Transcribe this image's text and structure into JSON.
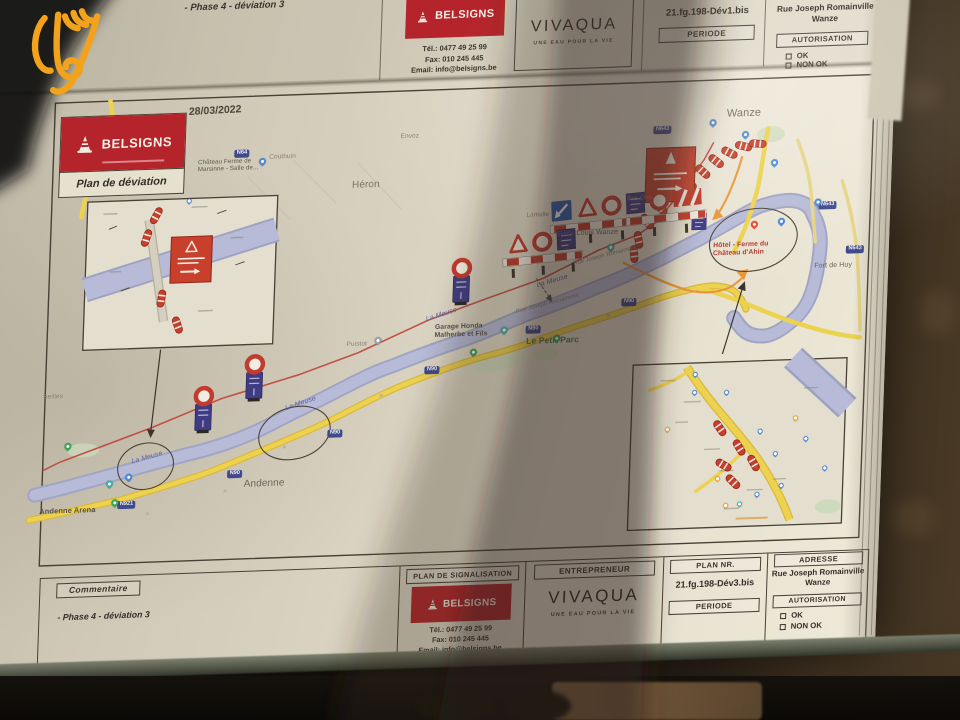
{
  "watermark": {
    "icon": "hand-logo",
    "color": "#F2A31B"
  },
  "upper_page": {
    "comment": "- Phase 4 - déviation 3",
    "belsigns": {
      "name": "BELSIGNS",
      "tel": "Tél.: 0477 49 25 99",
      "fax": "Fax: 010 245 445",
      "email": "Email: info@belsigns.be"
    },
    "vivaqua": {
      "name": "VIVAQUA",
      "tagline": "UNE EAU POUR LA VIE"
    },
    "plan_nr": "21.fg.198-Dév1.bis",
    "periode_label": "PERIODE",
    "adresse_line1": "Rue Joseph Romainville",
    "adresse_line2": "Wanze",
    "autorisation_label": "AUTORISATION",
    "ok_label": "OK",
    "non_ok_label": "NON OK"
  },
  "map": {
    "date": "28/03/2022",
    "legend_brand": "BELSIGNS",
    "legend_title": "Plan de déviation",
    "labels": [
      {
        "t": "Wanze",
        "x": 733,
        "y": 158,
        "s": 11,
        "c": "#6b6459"
      },
      {
        "t": "Héron",
        "x": 360,
        "y": 217,
        "s": 10,
        "c": "#7a7366"
      },
      {
        "t": "Couthuin",
        "x": 276,
        "y": 188,
        "s": 6.5,
        "c": "#8a8376"
      },
      {
        "t": "Envoz",
        "x": 407,
        "y": 172,
        "s": 6.5,
        "c": "#8a8376"
      },
      {
        "t": "Château Ferme de\nMarsinne - Salle de...",
        "x": 205,
        "y": 192,
        "s": 6.2,
        "c": "#5c564c"
      },
      {
        "t": "Andenne",
        "x": 262,
        "y": 512,
        "s": 10,
        "c": "#6b6459"
      },
      {
        "t": "Andenne Arena",
        "x": 58,
        "y": 534,
        "s": 7.5,
        "c": "#55504a",
        "b": 1
      },
      {
        "t": "Seilles",
        "x": 58,
        "y": 420,
        "s": 6.5,
        "c": "#8a8376"
      },
      {
        "t": "La Meuse",
        "x": 148,
        "y": 488,
        "s": 7,
        "c": "#5a64a0",
        "i": 1,
        "r": -14
      },
      {
        "t": "La Meuse",
        "x": 300,
        "y": 440,
        "s": 7,
        "c": "#5a64a0",
        "i": 1,
        "r": -17
      },
      {
        "t": "La Meuse",
        "x": 438,
        "y": 356,
        "s": 7,
        "c": "#5a64a0",
        "i": 1,
        "r": -16
      },
      {
        "t": "La Meuse",
        "x": 548,
        "y": 326,
        "s": 7,
        "c": "#5a64a0",
        "i": 1,
        "r": -15
      },
      {
        "t": "Le Petit Parc",
        "x": 540,
        "y": 380,
        "s": 8.5,
        "c": "#4a7a52",
        "b": 1
      },
      {
        "t": "Garage Honda\nMalherbe et Fils",
        "x": 448,
        "y": 364,
        "s": 6.8,
        "c": "#55504a",
        "b": 1
      },
      {
        "t": "Puistot",
        "x": 360,
        "y": 378,
        "s": 6.5,
        "c": "#8a8376"
      },
      {
        "t": "Stade Louis Wanze",
        "x": 566,
        "y": 275,
        "s": 7,
        "c": "#6b6459"
      },
      {
        "t": "Bas-Oha",
        "x": 636,
        "y": 243,
        "s": 6.2,
        "c": "#8a8376"
      },
      {
        "t": "Lamalle",
        "x": 536,
        "y": 256,
        "s": 6.2,
        "c": "#8a8376"
      },
      {
        "t": "Fort de Huy",
        "x": 826,
        "y": 316,
        "s": 7,
        "c": "#6b6459"
      },
      {
        "t": "Hôtel - Ferme du\nChâteau d'Ahin",
        "x": 724,
        "y": 292,
        "s": 6.8,
        "c": "#b03a30",
        "b": 1
      },
      {
        "t": "Rue Joseph Romainville",
        "x": 528,
        "y": 352,
        "s": 5.8,
        "c": "#8a8376",
        "r": -13
      },
      {
        "t": "Rue Joseph Romainville",
        "x": 584,
        "y": 306,
        "s": 5.8,
        "c": "#8a8376",
        "r": -13
      }
    ],
    "badges": [
      {
        "t": "N64",
        "x": 241,
        "y": 183
      },
      {
        "t": "N64",
        "x": 100,
        "y": 217
      },
      {
        "t": "N921",
        "x": 136,
        "y": 530
      },
      {
        "t": "N90",
        "x": 245,
        "y": 503
      },
      {
        "t": "N90",
        "x": 344,
        "y": 466
      },
      {
        "t": "N90",
        "x": 439,
        "y": 406
      },
      {
        "t": "N90",
        "x": 539,
        "y": 369
      },
      {
        "t": "N90",
        "x": 634,
        "y": 345
      },
      {
        "t": "N643",
        "x": 828,
        "y": 255
      },
      {
        "t": "N643",
        "x": 857,
        "y": 300
      },
      {
        "t": "N643",
        "x": 660,
        "y": 174
      }
    ],
    "pins": [
      {
        "x": 269,
        "y": 199,
        "c": "#4a89dc"
      },
      {
        "x": 517,
        "y": 376,
        "c": "#3bafa8"
      },
      {
        "x": 570,
        "y": 386,
        "c": "#34a853"
      },
      {
        "x": 391,
        "y": 382,
        "c": "#9aa0a6"
      },
      {
        "x": 487,
        "y": 397,
        "c": "#34a853"
      },
      {
        "x": 84,
        "y": 477,
        "c": "#34a853"
      },
      {
        "x": 127,
        "y": 516,
        "c": "#3bafa8"
      },
      {
        "x": 146,
        "y": 510,
        "c": "#4a89dc"
      },
      {
        "x": 133,
        "y": 535,
        "c": "#34a853"
      },
      {
        "x": 621,
        "y": 297,
        "c": "#3bafa8"
      },
      {
        "x": 764,
        "y": 279,
        "c": "#ea4335"
      },
      {
        "x": 791,
        "y": 277,
        "c": "#4a89dc"
      },
      {
        "x": 719,
        "y": 176,
        "c": "#4a89dc"
      },
      {
        "x": 752,
        "y": 189,
        "c": "#4a89dc"
      },
      {
        "x": 782,
        "y": 218,
        "c": "#4a89dc"
      },
      {
        "x": 827,
        "y": 259,
        "c": "#4a89dc"
      },
      {
        "x": 197,
        "y": 235,
        "c": "#4a89dc",
        "s": 5
      },
      {
        "x": 710,
        "y": 426,
        "c": "#4a89dc",
        "s": 5
      },
      {
        "x": 742,
        "y": 445,
        "c": "#4a89dc",
        "s": 5
      },
      {
        "x": 777,
        "y": 485,
        "c": "#4a89dc",
        "s": 5
      },
      {
        "x": 823,
        "y": 494,
        "c": "#4a89dc",
        "s": 5
      },
      {
        "x": 843,
        "y": 524,
        "c": "#4a89dc",
        "s": 5
      },
      {
        "x": 793,
        "y": 508,
        "c": "#4a89dc",
        "s": 5
      },
      {
        "x": 800,
        "y": 540,
        "c": "#4a89dc",
        "s": 5
      },
      {
        "x": 776,
        "y": 548,
        "c": "#4a89dc",
        "s": 5
      },
      {
        "x": 759,
        "y": 557,
        "c": "#3bafa8",
        "s": 5
      },
      {
        "x": 736,
        "y": 531,
        "c": "#f5a623",
        "s": 5
      },
      {
        "x": 745,
        "y": 558,
        "c": "#f5a623",
        "s": 5
      },
      {
        "x": 812,
        "y": 473,
        "c": "#f5a623",
        "s": 5
      },
      {
        "x": 684,
        "y": 480,
        "c": "#f5a623",
        "s": 5
      },
      {
        "x": 710,
        "y": 444,
        "c": "#4a89dc",
        "s": 5
      }
    ]
  },
  "title_block": {
    "commentaire_label": "Commentaire",
    "comment": "- Phase 4 - déviation 3",
    "plan_signalisation_label": "PLAN DE SIGNALISATION",
    "belsigns": {
      "name": "BELSIGNS",
      "tel": "Tél.: 0477 49 25 99",
      "fax": "Fax: 010 245 445",
      "email": "Email: info@belsigns.be"
    },
    "entrepreneur_label": "ENTREPRENEUR",
    "vivaqua": {
      "name": "VIVAQUA",
      "tagline": "UNE EAU POUR LA VIE"
    },
    "plan_nr_label": "PLAN NR.",
    "plan_nr_value": "21.fg.198-Dév3.bis",
    "periode_label": "PERIODE",
    "adresse_label": "ADRESSE",
    "adresse_line1": "Rue Joseph Romainville",
    "adresse_line2": "Wanze",
    "autorisation_label": "AUTORISATION",
    "ok_label": "OK",
    "non_ok_label": "NON OK"
  },
  "colors": {
    "brand_red": "#b5242a",
    "river": "#b7bbd8",
    "road_yellow": "#edd24f",
    "detour_red": "#bf4438",
    "watermark_orange": "#F2A31B"
  }
}
